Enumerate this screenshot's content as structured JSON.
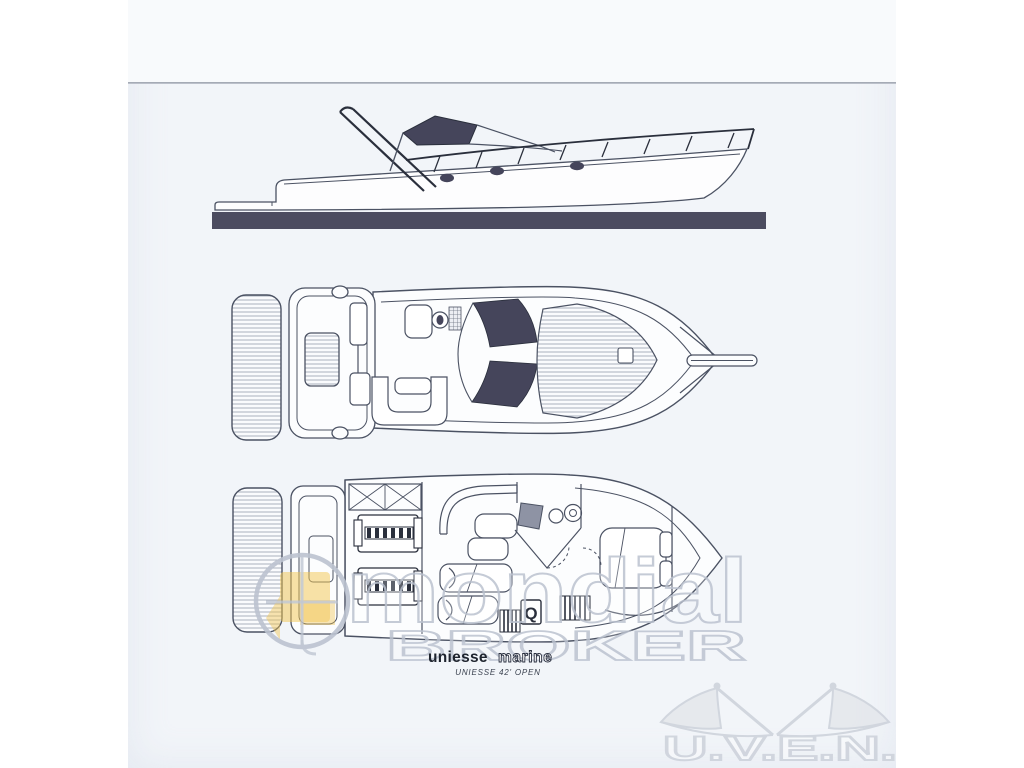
{
  "brand": {
    "name_primary": "uniesse",
    "name_secondary": "marine",
    "model": "UNIESSE 42' OPEN"
  },
  "watermark": {
    "word_large": "mondial",
    "word_spaced": "BROKER"
  },
  "corner_logo": {
    "text": "U.V.E.N."
  },
  "plan": {
    "appliance_label": "Q"
  },
  "colors": {
    "ink": "#4b5263",
    "ink_dark": "#2a2f3c",
    "fill_dark": "#45455b",
    "hull_bar": "#4c4c60",
    "page_bg": "#f2f5f9",
    "page_top": "#f8fafc",
    "watermark": "#bcc3d0",
    "accent_yellow": "#f2c44d",
    "logo_gray": "#ccd1da",
    "shade_gray": "#8e93a4",
    "text_dark": "#1f242e"
  }
}
